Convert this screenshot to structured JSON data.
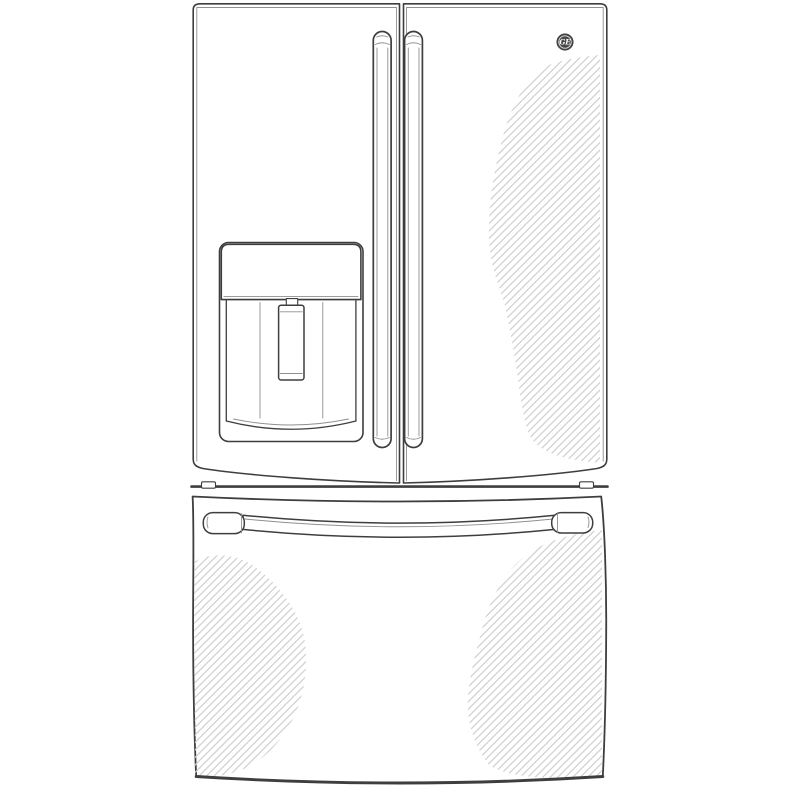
{
  "illustration": {
    "type": "product-line-drawing",
    "subject": "french-door-refrigerator-with-bottom-freezer-drawer",
    "colors": {
      "outline": "#3e3e3e",
      "secondary_line": "#8f8f8f",
      "hatch": "#cfcfcf",
      "surface": "#ffffff",
      "background": "#ffffff",
      "badge": "#4a4a4a"
    },
    "components": [
      "left-refrigerator-door",
      "right-refrigerator-door",
      "left-door-handle",
      "right-door-handle",
      "ice-water-dispenser",
      "dispenser-control-panel",
      "dispenser-paddle",
      "ge-logo-badge",
      "cabinet-divider",
      "hinge-feet",
      "freezer-drawer",
      "freezer-drawer-handle",
      "stainless-sheen-hatching"
    ]
  },
  "brand": {
    "monogram": "GE"
  }
}
